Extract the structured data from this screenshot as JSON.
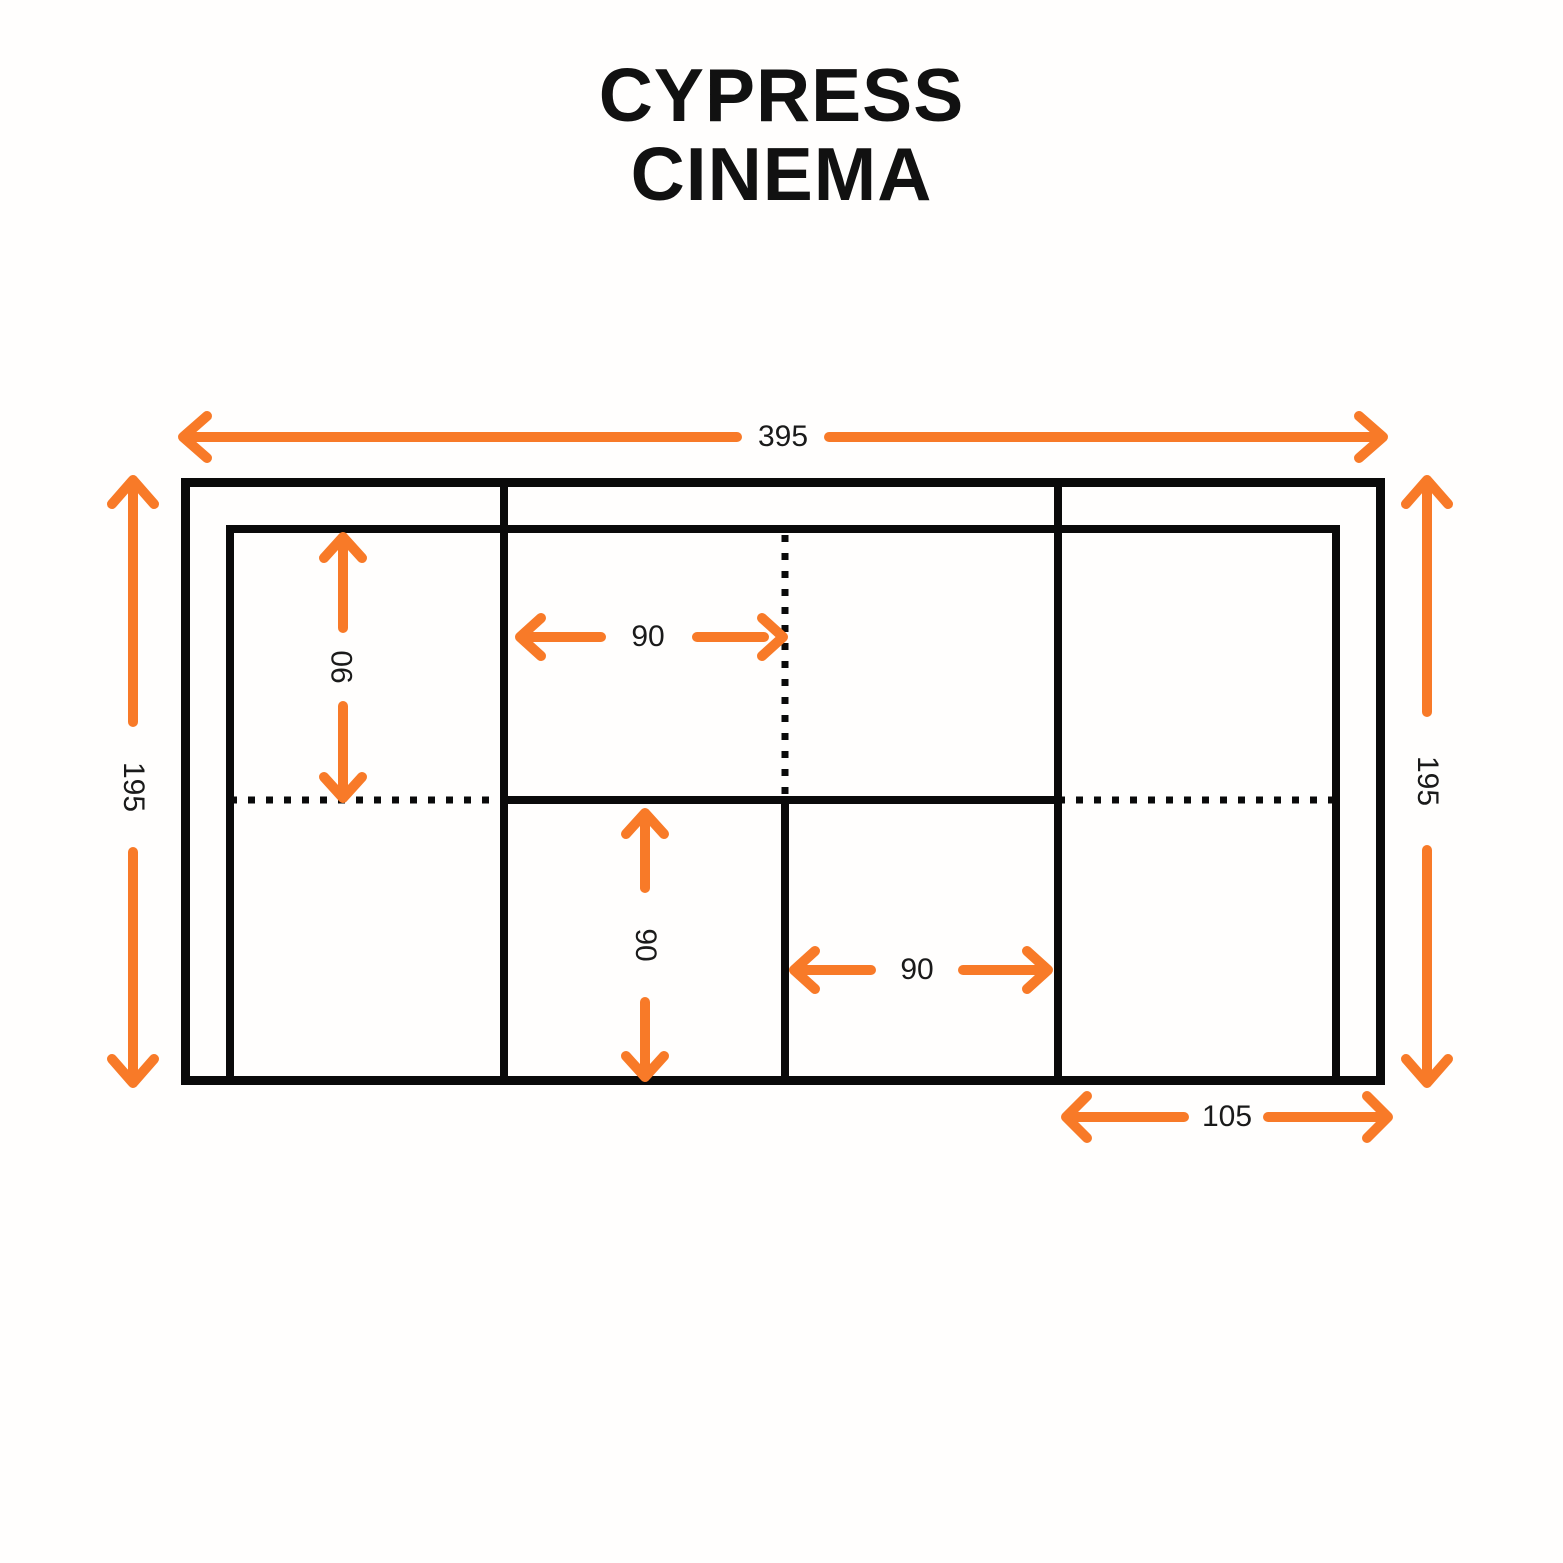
{
  "title": {
    "line1": "CYPRESS",
    "line2": "CINEMA"
  },
  "colors": {
    "accent_orange": "#F87A28",
    "line_black": "#0A0A0A",
    "background": "#FFFEFD",
    "text": "#111111"
  },
  "diagram": {
    "kind": "sofa top-view dimension drawing",
    "units": "cm",
    "dimensions": {
      "overall_width": "395",
      "overall_depth_left": "195",
      "overall_depth_right": "195",
      "left_seat_depth": "90",
      "center_section_width": "90",
      "center_seat_depth": "90",
      "right_seat_width": "90",
      "right_module_width": "105"
    }
  }
}
